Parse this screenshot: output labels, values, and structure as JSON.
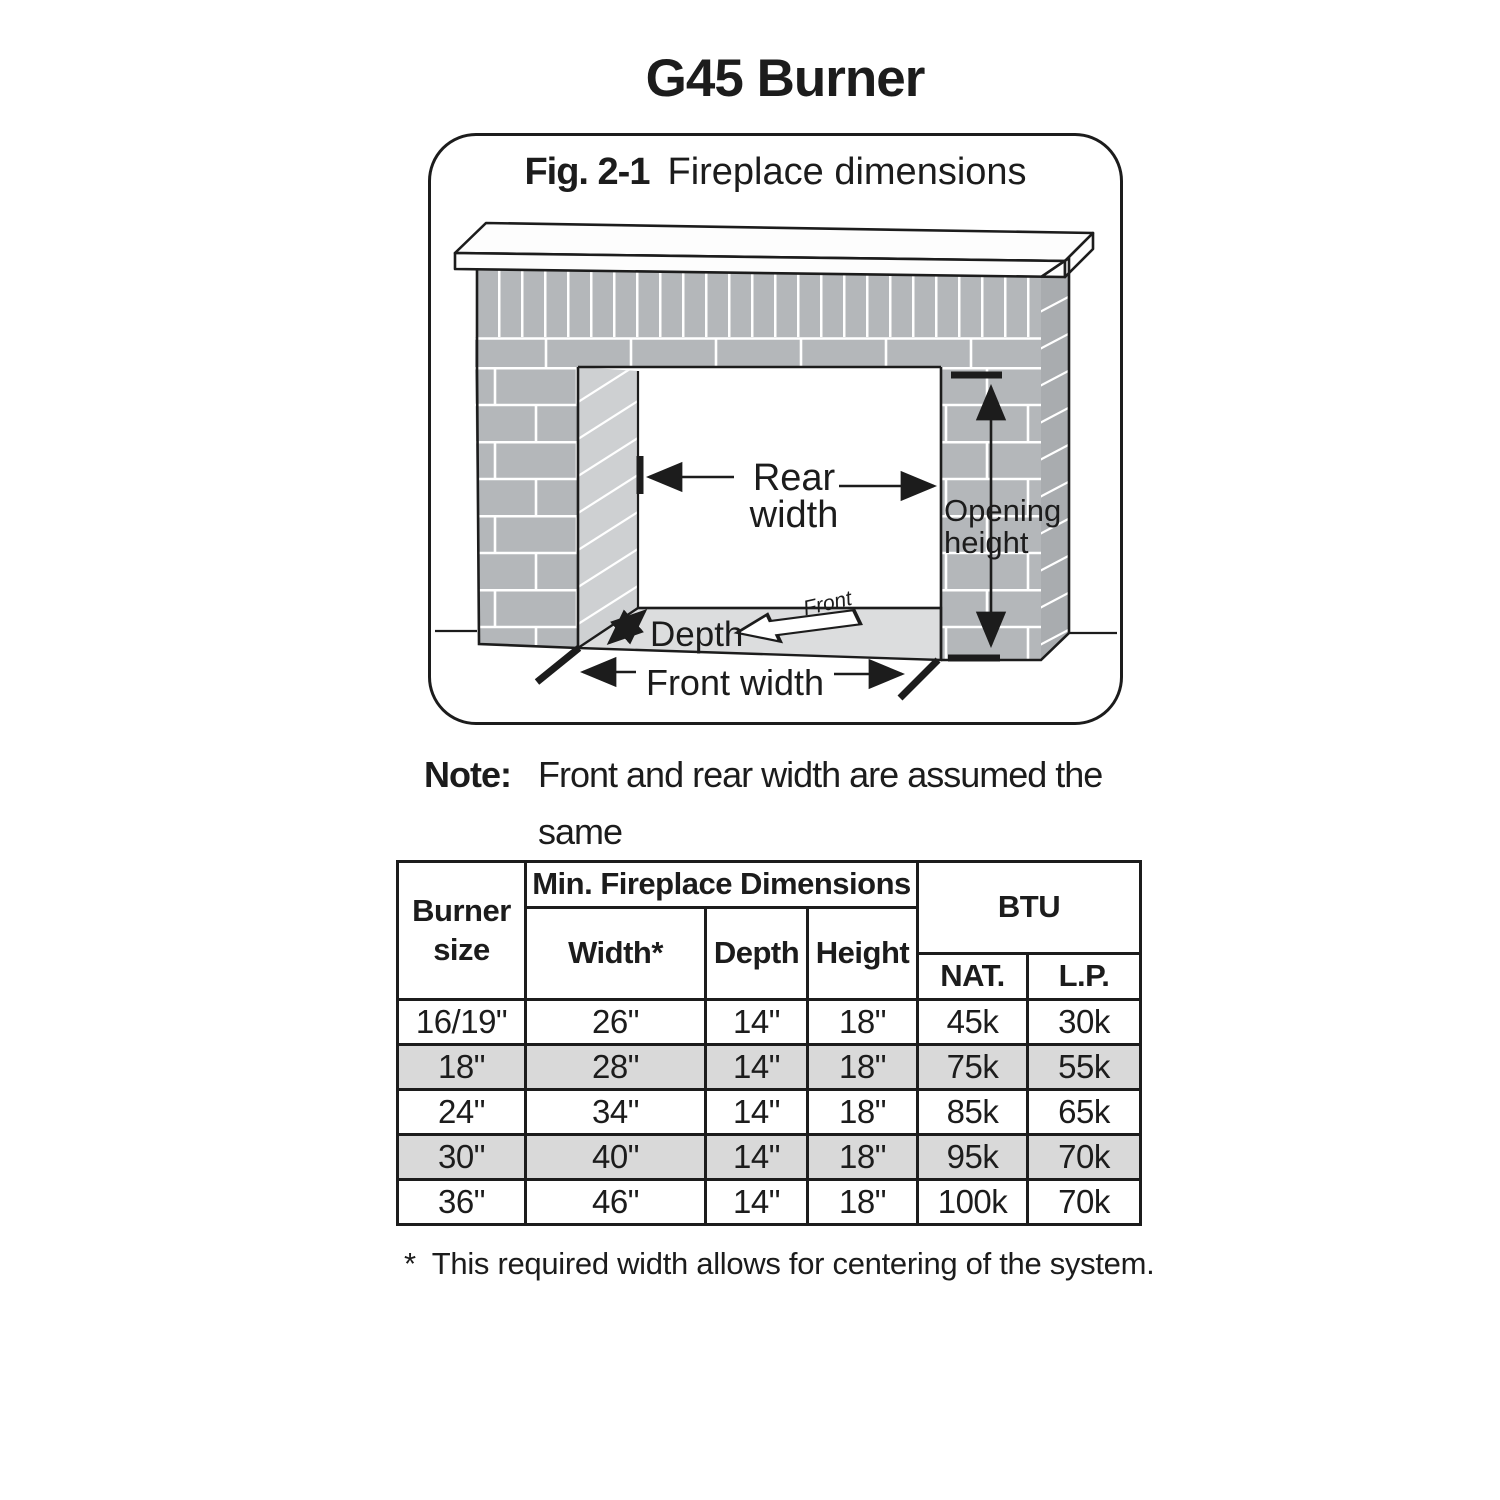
{
  "page": {
    "title": "G45 Burner"
  },
  "figure": {
    "caption_label": "Fig. 2-1",
    "caption_text": "Fireplace dimensions",
    "labels": {
      "rear_width_line1": "Rear",
      "rear_width_line2": "width",
      "opening_height_line1": "Opening",
      "opening_height_line2": "height",
      "depth": "Depth",
      "front": "Front",
      "front_width": "Front width"
    }
  },
  "note": {
    "label": "Note:",
    "line1": "Front and rear width are assumed the same",
    "line2": "for see-through fireplaces."
  },
  "table": {
    "header": {
      "burner_size": "Burner size",
      "min_dims": "Min. Fireplace Dimensions",
      "btu": "BTU",
      "width": "Width*",
      "depth": "Depth",
      "height": "Height",
      "nat": "NAT.",
      "lp": "L.P."
    },
    "rows": [
      {
        "size": "16/19\"",
        "width": "26\"",
        "depth": "14\"",
        "height": "18\"",
        "nat": "45k",
        "lp": "30k",
        "shaded": false
      },
      {
        "size": "18\"",
        "width": "28\"",
        "depth": "14\"",
        "height": "18\"",
        "nat": "75k",
        "lp": "55k",
        "shaded": true
      },
      {
        "size": "24\"",
        "width": "34\"",
        "depth": "14\"",
        "height": "18\"",
        "nat": "85k",
        "lp": "65k",
        "shaded": false
      },
      {
        "size": "30\"",
        "width": "40\"",
        "depth": "14\"",
        "height": "18\"",
        "nat": "95k",
        "lp": "70k",
        "shaded": true
      },
      {
        "size": "36\"",
        "width": "46\"",
        "depth": "14\"",
        "height": "18\"",
        "nat": "100k",
        "lp": "70k",
        "shaded": false
      }
    ]
  },
  "footnote": {
    "marker": "*",
    "text": "This required width allows for centering of the system."
  },
  "colors": {
    "ink": "#1c1c1c",
    "brick": "#b4b7ba",
    "brick_jamb": "#ced0d2",
    "brick_side": "#a9acaf",
    "hearth": "#dcddde",
    "shaded_row": "#d9d9d9"
  }
}
